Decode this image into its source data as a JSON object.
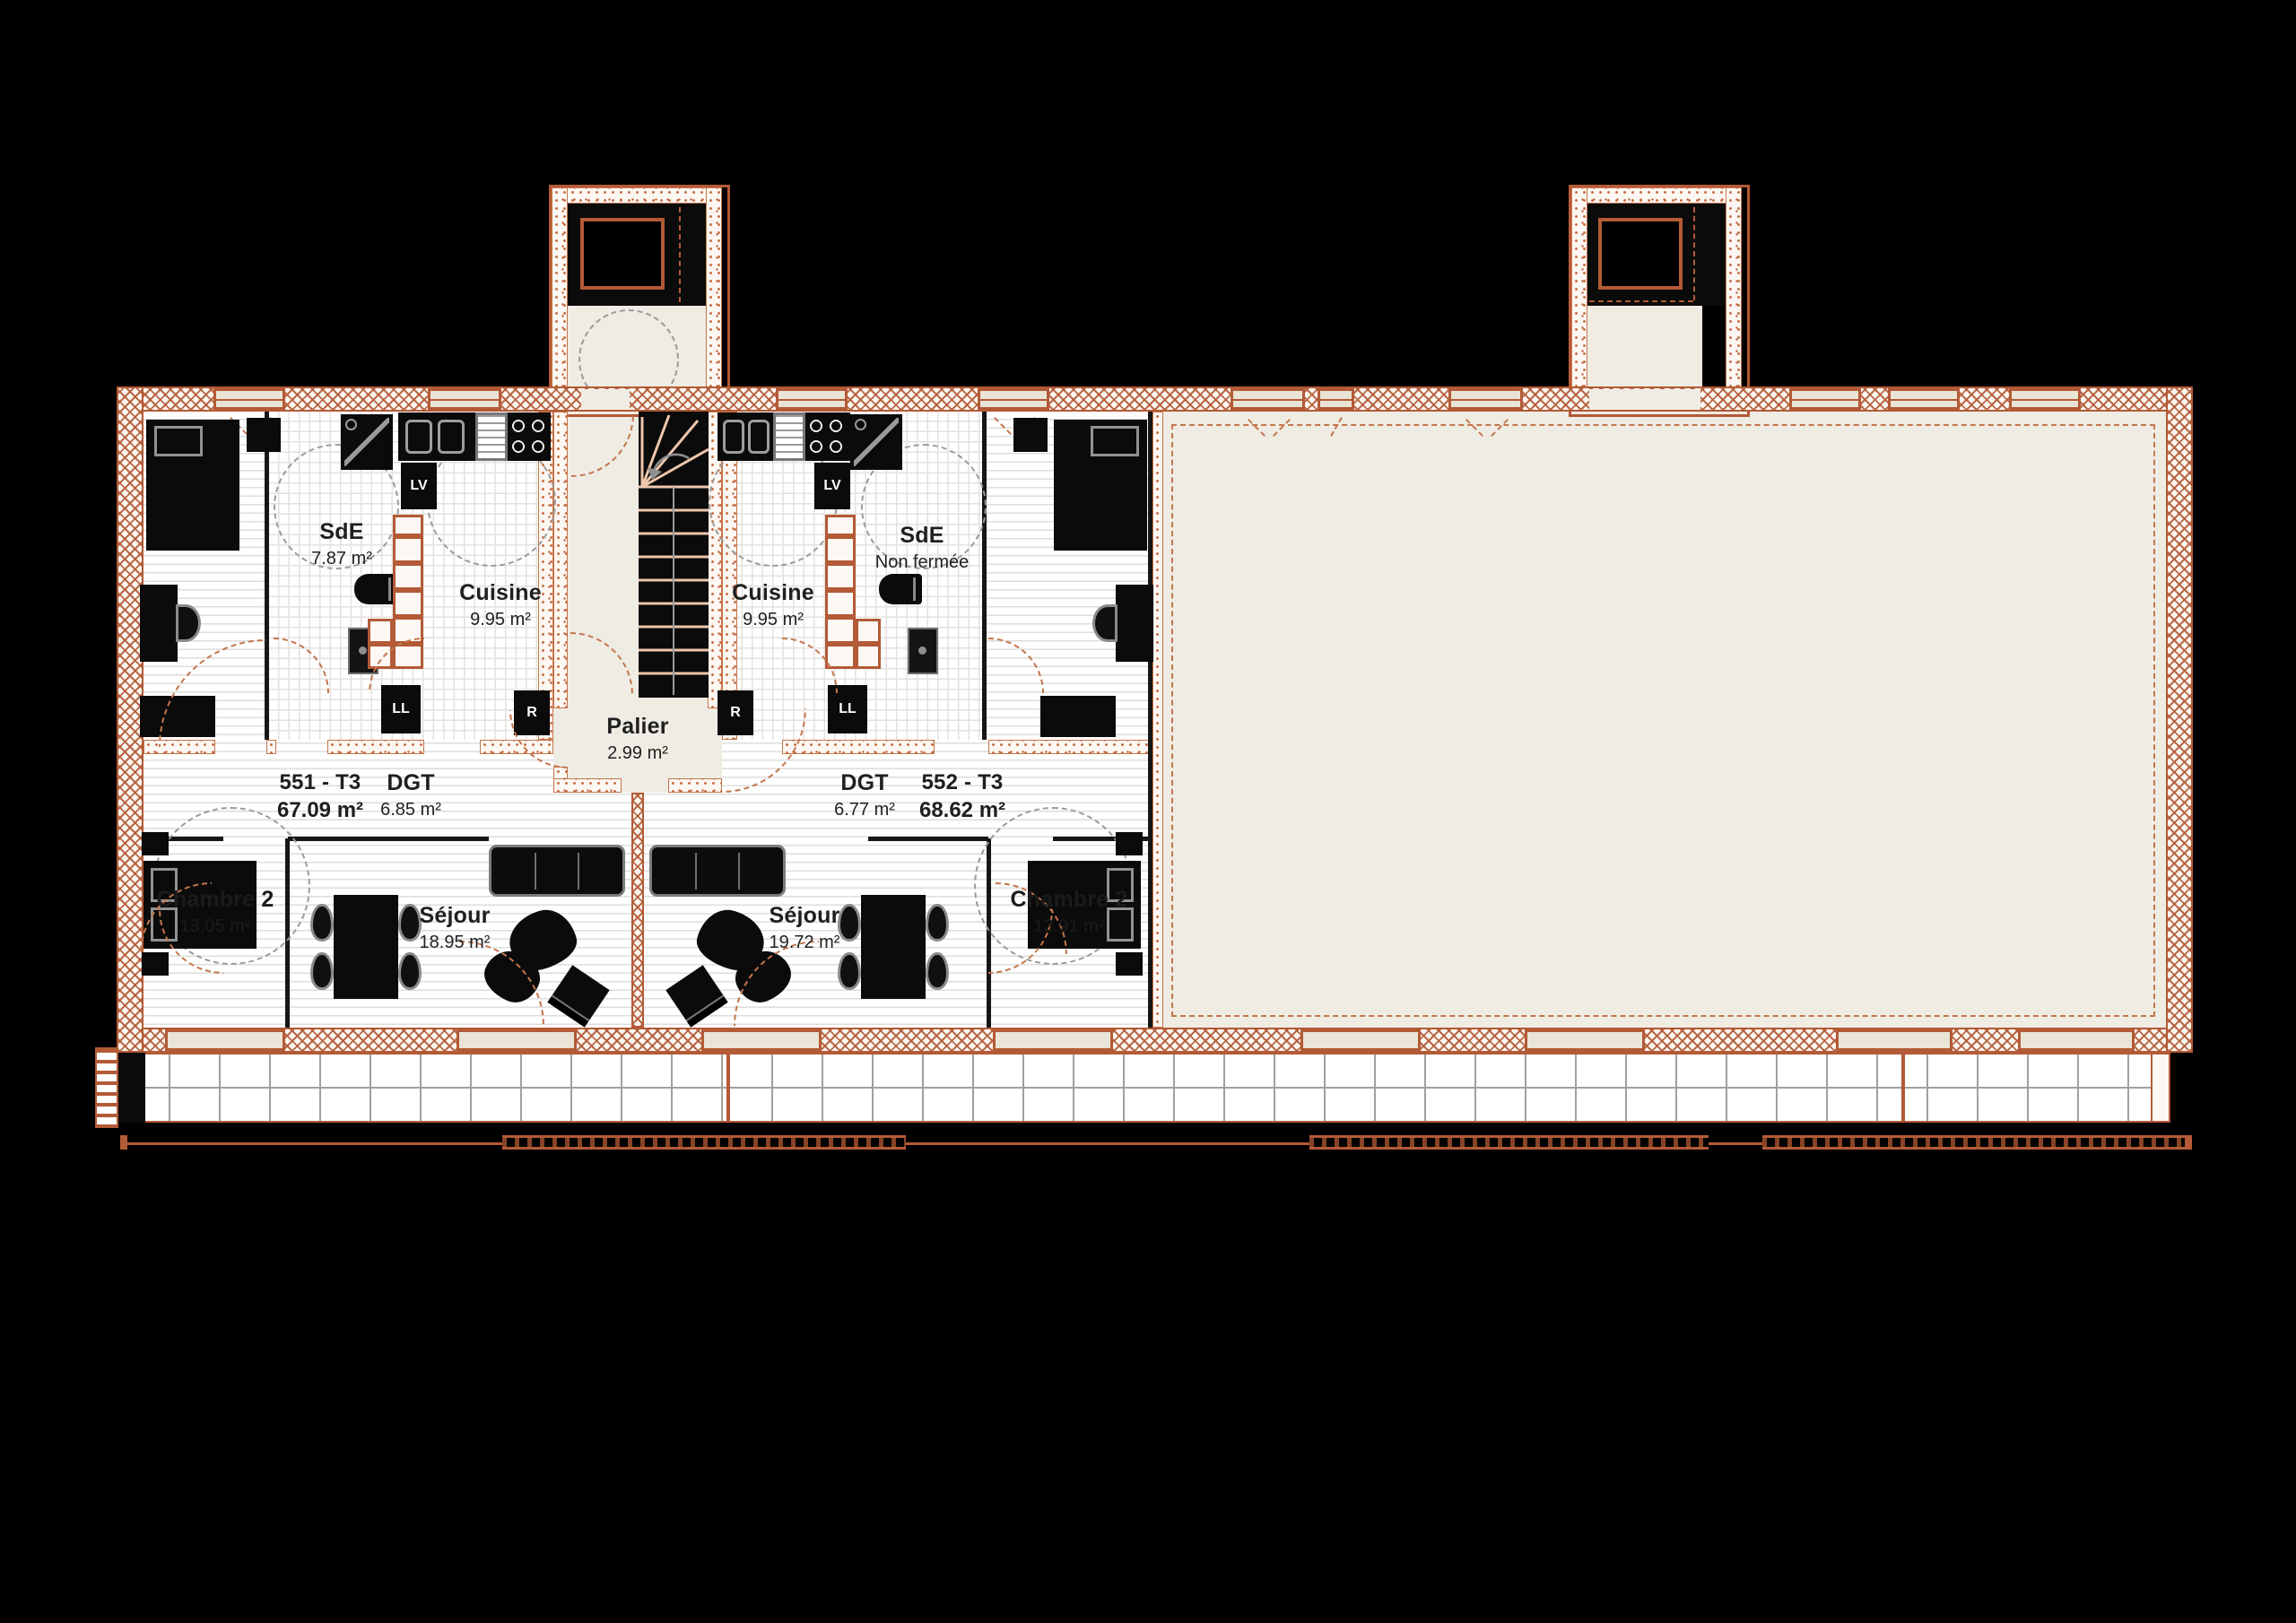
{
  "meta": {
    "type": "architectural-floor-plan",
    "background": "#000000"
  },
  "colors": {
    "wall_accent": "#b35a36",
    "floor": "#ffffff",
    "cream": "#efece4",
    "furniture": "#0b0b0b"
  },
  "units": [
    {
      "id": "551 - T3",
      "area": "67.09 m²",
      "rooms": {
        "sde": {
          "name": "SdE",
          "area": "7.87 m²"
        },
        "cuisine": {
          "name": "Cuisine",
          "area": "9.95 m²"
        },
        "dgt": {
          "name": "DGT",
          "area": "6.85 m²"
        },
        "sejour": {
          "name": "Séjour",
          "area": "18.95 m²"
        },
        "chambre": {
          "name": "Chambre 2",
          "area": "13.05 m²"
        }
      }
    },
    {
      "id": "552 - T3",
      "area": "68.62 m²",
      "rooms": {
        "cuisine": {
          "name": "Cuisine",
          "area": "9.95 m²"
        },
        "sde": {
          "name": "SdE",
          "note": "Non fermée"
        },
        "dgt": {
          "name": "DGT",
          "area": "6.77 m²"
        },
        "sejour": {
          "name": "Séjour",
          "area": "19.72 m²"
        },
        "chambre": {
          "name": "Chambre 2",
          "area": "12.91 m²"
        }
      }
    }
  ],
  "common": {
    "palier": {
      "name": "Palier",
      "area": "2.99 m²"
    }
  },
  "appliances": {
    "dishwasher": "LV",
    "washer": "LL",
    "fridge": "R"
  }
}
